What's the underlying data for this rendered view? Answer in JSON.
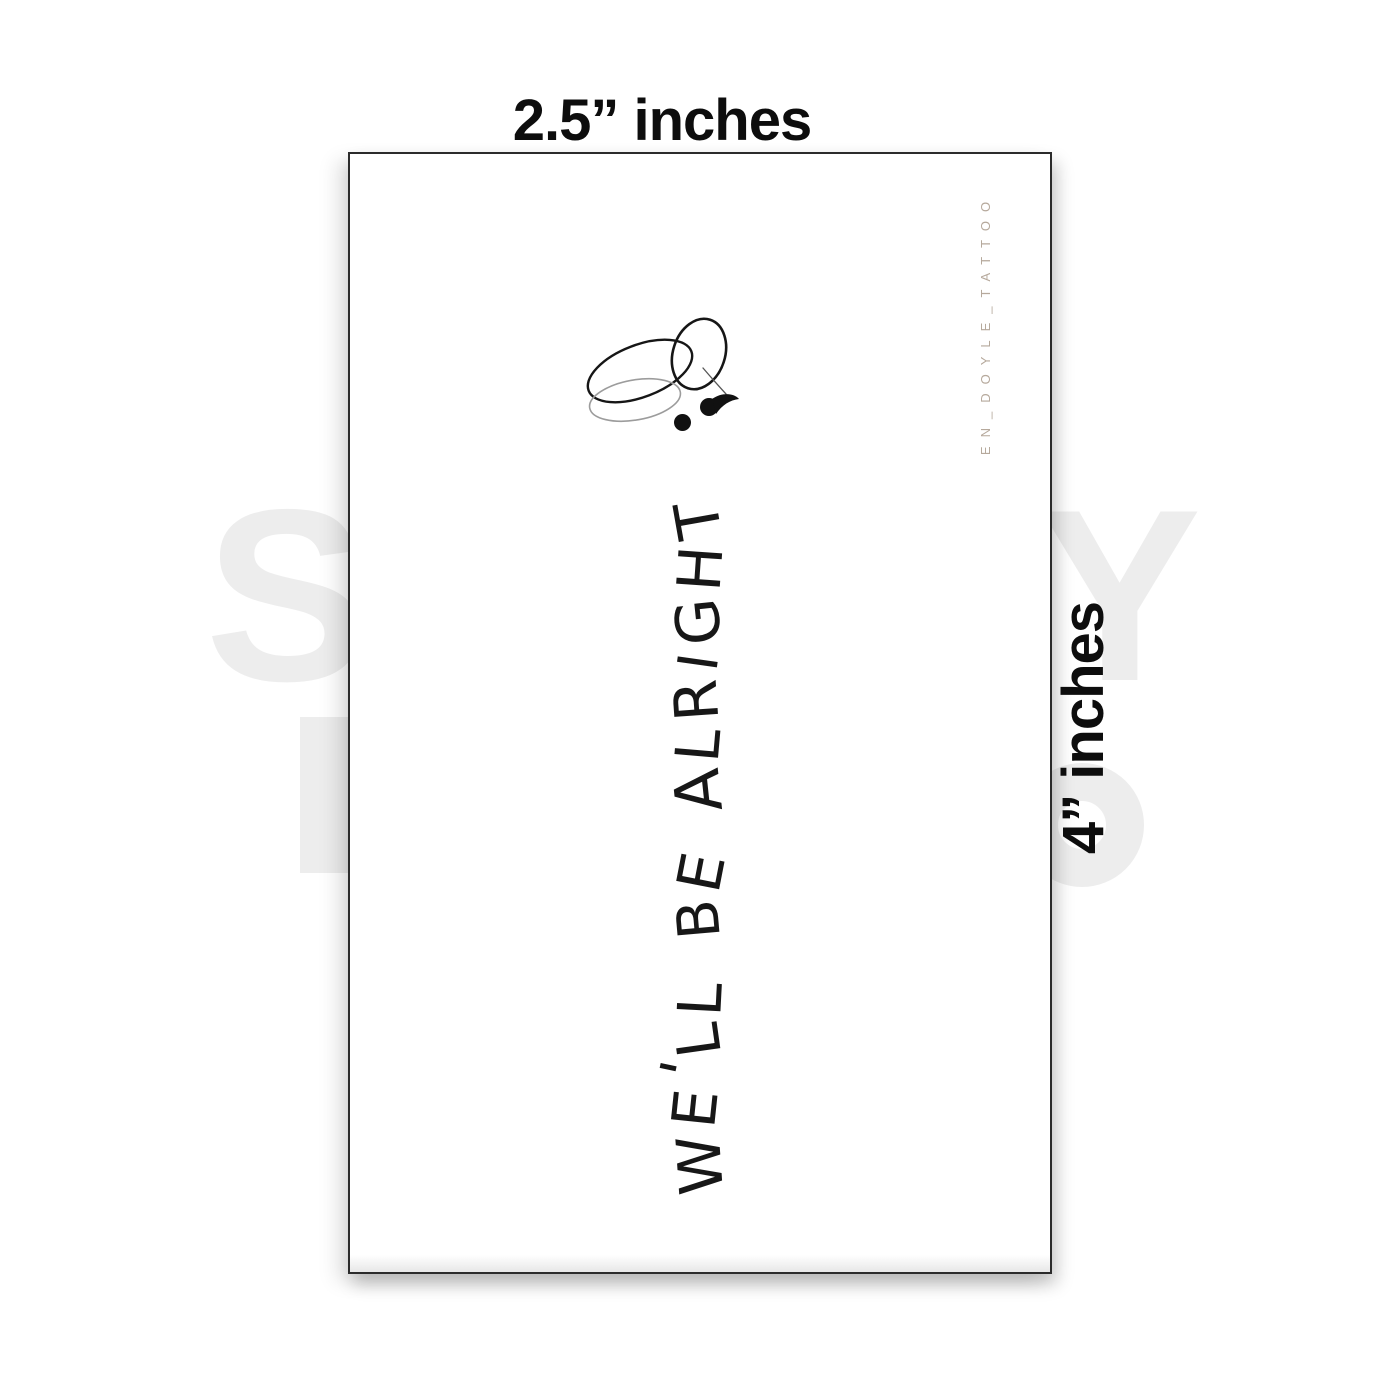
{
  "dimension_labels": {
    "top": "2.5” inches",
    "side": "4” inches"
  },
  "tattoo": {
    "phrase": "WE'LL BE ALRIGHT",
    "credit": "EN_DOYLE_TATTOO",
    "design": "butterfly-semicolon"
  },
  "watermark": {
    "left_letter": "S",
    "right_letter": "Y"
  },
  "colors": {
    "ink": "#171717",
    "wing_light": "#9c9c9c",
    "credit_text": "#b6a99c",
    "watermark": "#ededed",
    "card_border": "#2b2b2b",
    "label_text": "#0d0d0d"
  }
}
